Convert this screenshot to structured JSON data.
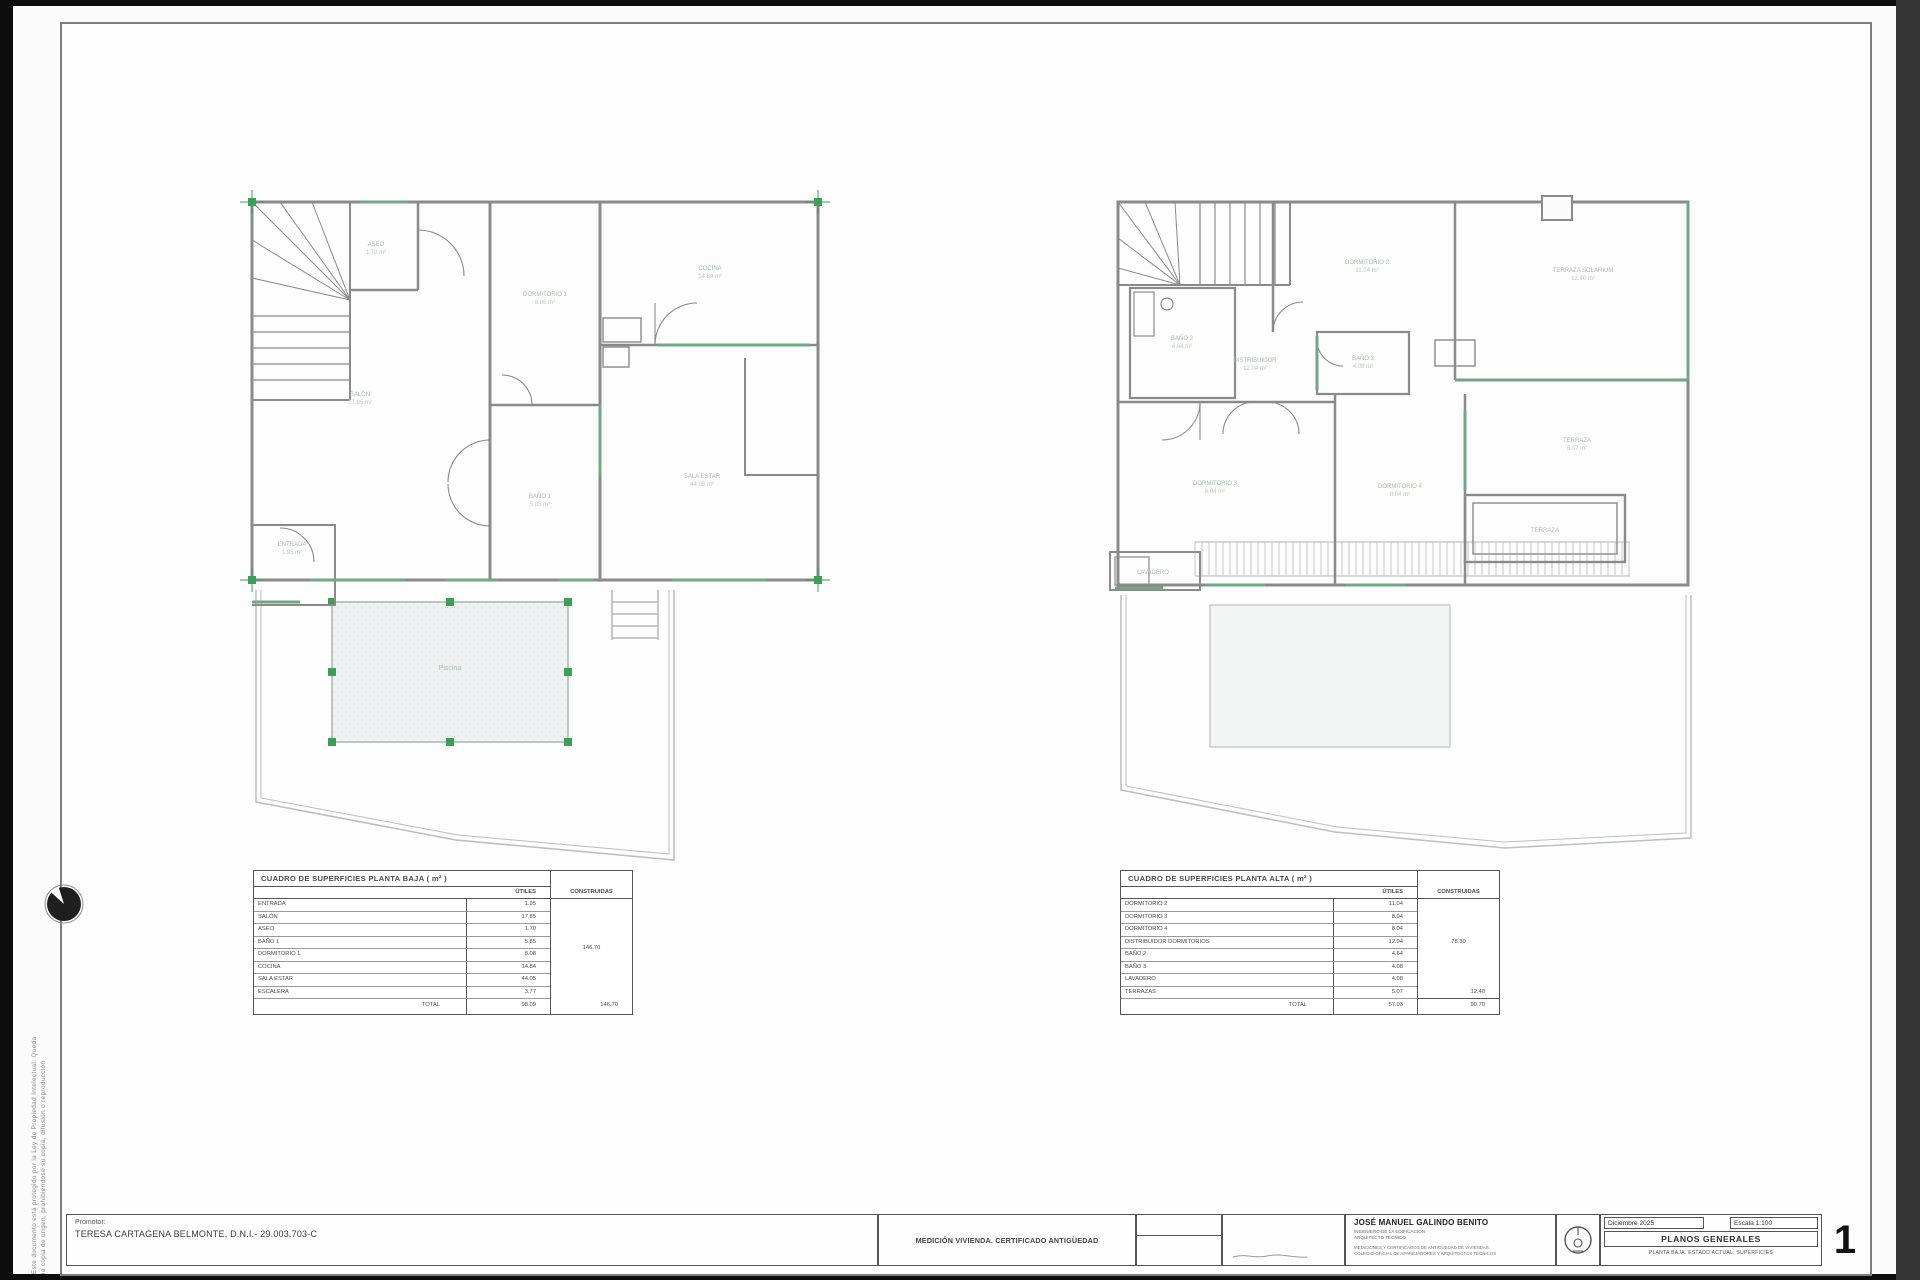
{
  "colors": {
    "accent_green": "#74a683",
    "marker_green": "#3f9e55",
    "wall_gray": "#8a8a8a",
    "label_green": "#a0c2a8"
  },
  "margin_note": {
    "line1": "Este documento está protegido por la Ley de Propiedad Intelectual. Queda",
    "line2": "la copia de origen, prohibiéndose su copia, difusión o reproducción"
  },
  "left_table": {
    "title": "CUADRO DE SUPERFICIES PLANTA BAJA ( m² )",
    "col_utiles": "ÚTILES",
    "col_construidas": "CONSTRUIDAS",
    "rows": [
      [
        "ENTRADA",
        "1.95"
      ],
      [
        "SALÓN",
        "17.85"
      ],
      [
        "ASEO",
        "1.70"
      ],
      [
        "BAÑO 1",
        "5.85"
      ],
      [
        "DORMITORIO 1",
        "8.08"
      ],
      [
        "COCINA",
        "14.84"
      ],
      [
        "SALA ESTAR",
        "44.05"
      ],
      [
        "ESCALERA",
        "3.77"
      ]
    ],
    "construidas_merged": "146.70",
    "total_label": "TOTAL",
    "total_utiles": "98.09",
    "total_construidas": "146.70"
  },
  "right_table": {
    "title": "CUADRO DE SUPERFICIES PLANTA ALTA ( m² )",
    "col_utiles": "ÚTILES",
    "col_construidas": "CONSTRUIDAS",
    "rows": [
      [
        "DORMITORIO 2",
        "11.04"
      ],
      [
        "DORMITORIO 3",
        "8.04"
      ],
      [
        "DORMITORIO 4",
        "8.04"
      ],
      [
        "DISTRIBUIDOR DORMITORIOS",
        "12.04"
      ],
      [
        "BAÑO 2",
        "4.64"
      ],
      [
        "BAÑO 3",
        "4.08"
      ],
      [
        "LAVADERO",
        "4.08"
      ],
      [
        "TERRAZAS",
        "5.07"
      ]
    ],
    "construidas_merged": "78.30",
    "extra_construidas": "12.40",
    "total_label": "TOTAL",
    "total_utiles": "57.03",
    "total_construidas": "90.70"
  },
  "titleblock": {
    "promotor_label": "Promotor:",
    "promotor_name": "TERESA CARTAGENA BELMONTE, D.N.I.- 29.003.703-C",
    "project": "MEDICIÓN VIVIENDA. CERTIFICADO ANTIGÜEDAD",
    "tecnico_name": "JOSÉ MANUEL GALINDO BENITO",
    "tecnico_line1": "INGENIERO DE LA EDIFICACIÓN",
    "tecnico_line2": "ARQUITECTO TÉCNICO",
    "tecnico_line3": "MEDICIONES Y CERTIFICADOS DE ANTIGÜEDAD DE VIVIENDAS",
    "tecnico_line4": "COLEGIO OFICIAL DE APAREJADORES Y ARQUITECTOS TÉCNICOS",
    "date": "Diciembre 2025",
    "scale": "Escala 1:100",
    "series": "PLANOS GENERALES",
    "subtitle": "PLANTA BAJA. ESTADO ACTUAL. SUPERFICIES",
    "sheet_number": "1"
  },
  "left_plan": {
    "aseo": "ASEO",
    "aseo_area": "1.70 m²",
    "salon": "SALÓN",
    "salon_area": "17.85 m²",
    "dorm1": "DORMITORIO 1",
    "dorm1_area": "8.08 m²",
    "bano1": "BAÑO 1",
    "bano1_area": "5.85 m²",
    "cocina": "COCINA",
    "cocina_area": "14.84 m²",
    "sala": "SALA ESTAR",
    "sala_area": "44.05 m²",
    "entrada": "ENTRADA",
    "entrada_area": "1.95 m²",
    "piscina": "Piscina"
  },
  "right_plan": {
    "bano2": "BAÑO 2",
    "bano2_area": "4.64 m²",
    "distrib": "DISTRIBUIDOR",
    "distrib_area": "12.04 m²",
    "dorm2": "DORMITORIO 2",
    "dorm2_area": "11.04 m²",
    "solarium": "TERRAZA SOLARIUM",
    "solarium_area": "12.40 m²",
    "dorm3": "DORMITORIO 3",
    "dorm3_area": "8.04 m²",
    "dorm4": "DORMITORIO 4",
    "dorm4_area": "8.04 m²",
    "bano3": "BAÑO 3",
    "bano3_area": "4.08 m²",
    "terraza": "TERRAZA",
    "terraza_area": "5.07 m²",
    "terraza2": "TERRAZA",
    "lavadero": "LAVADERO"
  }
}
